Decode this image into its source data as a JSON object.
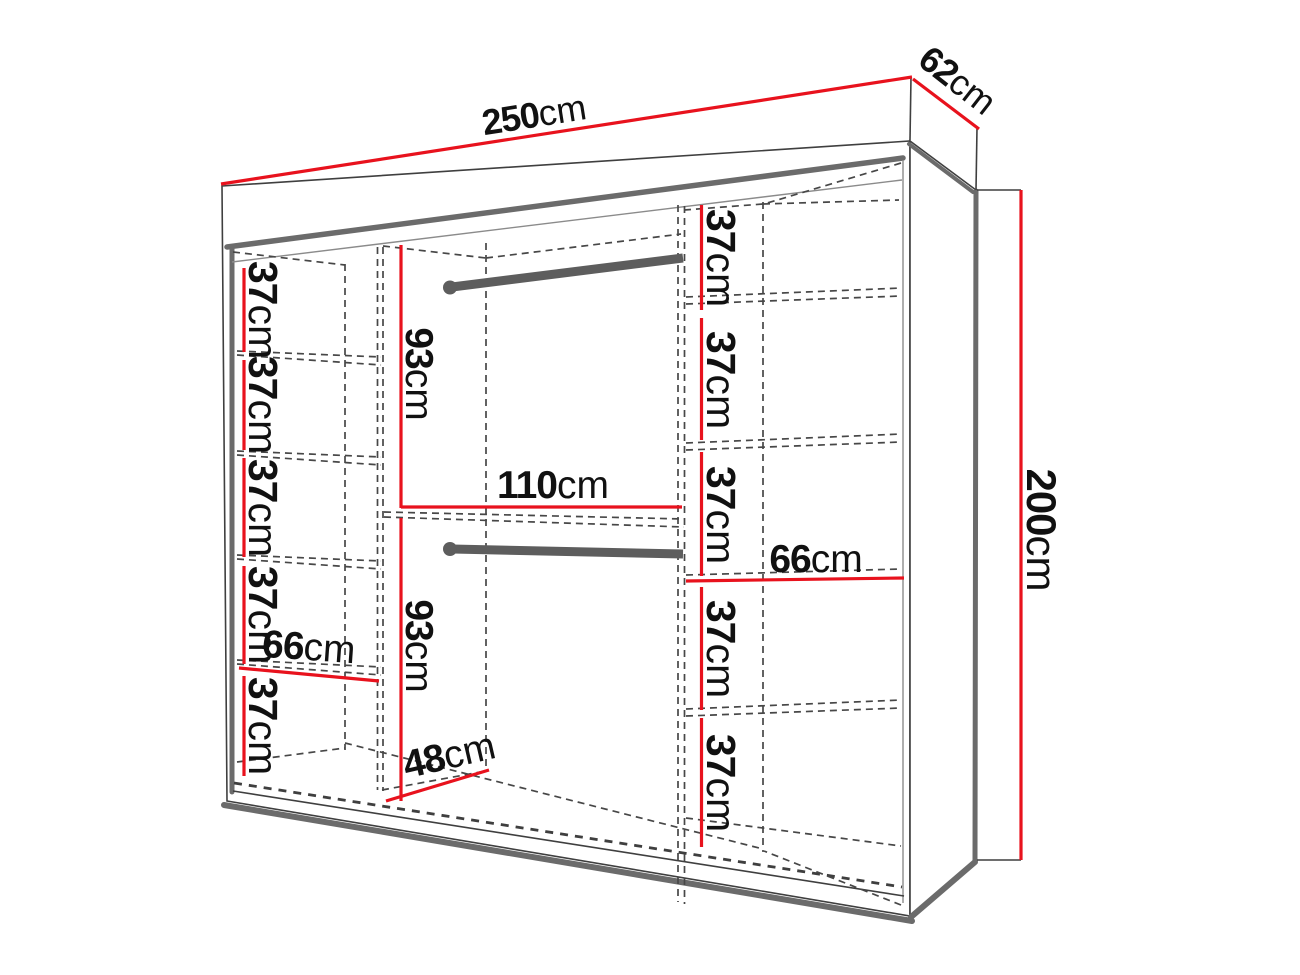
{
  "diagram": {
    "name": "wardrobe-interior-dimensions",
    "unit": "cm",
    "colors": {
      "dimension_line": "#e8121d",
      "outline": "#3f3f3f",
      "panel_shadow": "#6b6b6b",
      "rod": "#5d5d5d",
      "background": "#ffffff"
    },
    "overall": {
      "width": {
        "num": "250",
        "unit": "cm"
      },
      "depth": {
        "num": "62",
        "unit": "cm"
      },
      "height": {
        "num": "200",
        "unit": "cm"
      }
    },
    "middle_section": {
      "width": {
        "num": "110",
        "unit": "cm"
      },
      "upper_rod_height": {
        "num": "93",
        "unit": "cm"
      },
      "lower_rod_height": {
        "num": "93",
        "unit": "cm"
      },
      "floor_depth": {
        "num": "48",
        "unit": "cm"
      }
    },
    "left_column": {
      "shelf_width": {
        "num": "66",
        "unit": "cm"
      },
      "shelf_gaps": [
        {
          "num": "37",
          "unit": "cm"
        },
        {
          "num": "37",
          "unit": "cm"
        },
        {
          "num": "37",
          "unit": "cm"
        },
        {
          "num": "37",
          "unit": "cm"
        },
        {
          "num": "37",
          "unit": "cm"
        }
      ]
    },
    "right_column": {
      "shelf_width": {
        "num": "66",
        "unit": "cm"
      },
      "shelf_gaps": [
        {
          "num": "37",
          "unit": "cm"
        },
        {
          "num": "37",
          "unit": "cm"
        },
        {
          "num": "37",
          "unit": "cm"
        },
        {
          "num": "37",
          "unit": "cm"
        },
        {
          "num": "37",
          "unit": "cm"
        }
      ]
    }
  }
}
